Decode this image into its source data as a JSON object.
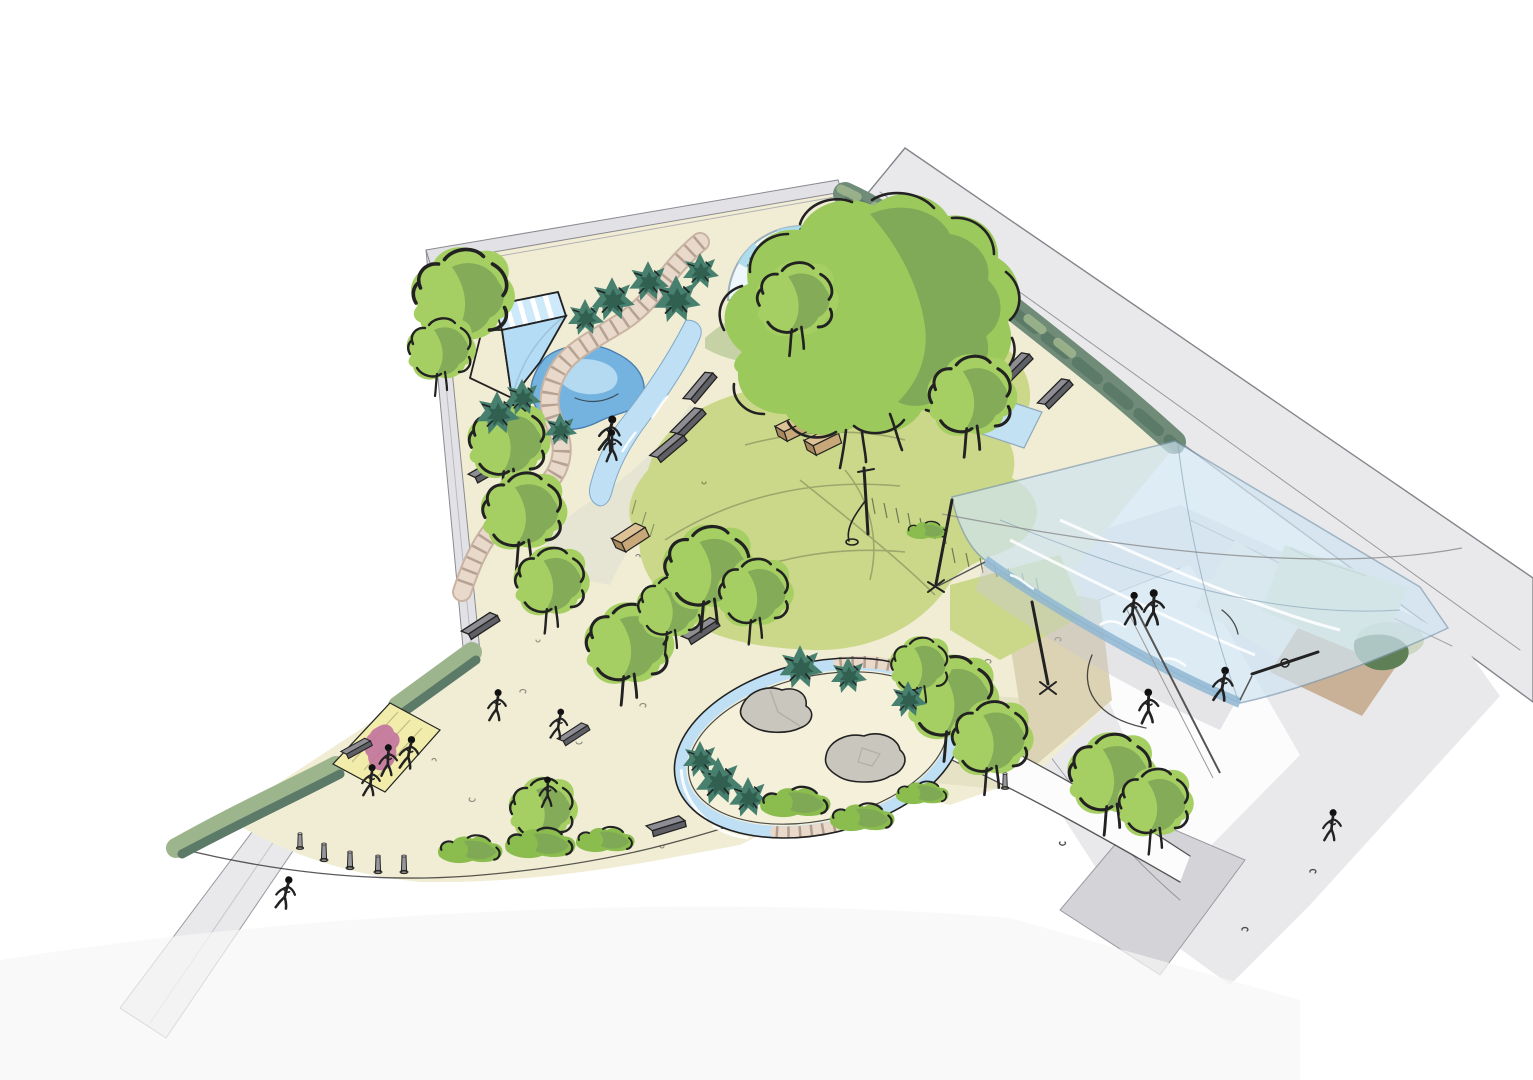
{
  "title": "Hand-drawn aerial concept sketch of a neighbourhood playground park",
  "palette": {
    "ink": "#222222",
    "road": "#e9e9eb",
    "roadShade": "#d4d4d8",
    "roadLine": "#84848a",
    "wall": "#e2e2e6",
    "ground": "#f1edd4",
    "groundShade": "#e3dec2",
    "lawn": "#ccd889",
    "lawnShade": "#b6c478",
    "sage": "#bcc998",
    "hedgeLight": "#9db58d",
    "hedgeMid": "#708c78",
    "hedgeDark": "#5c7a68",
    "treeLight": "#a5cf62",
    "treeMid": "#8abd4e",
    "treeShade": "#7da457",
    "conifer": "#47806f",
    "coniferDark": "#2f5c4e",
    "waterLight": "#bfe0f4",
    "water": "#74b3e0",
    "canopy": "#cfe4f1",
    "canopyEdge": "#8fb7d2",
    "slide": "#cde9fa",
    "slideShade": "#b5dcf5",
    "boardwalk": "#e9d9cb",
    "boardwalkTick": "#a08a7a",
    "bench": "#8d8d93",
    "benchDark": "#5f5f66",
    "planter": "#c8a878",
    "planterDark": "#a8895c",
    "rock": "#c9c6bd",
    "kiosk": "#f2ecab",
    "kioskAccent": "#c2739f",
    "bollard": "#97979d",
    "figure": "#111111"
  },
  "features": [
    "perimeter-road",
    "building-strip",
    "boundary-walls",
    "boundary-hedge",
    "entrance-kiosk",
    "entrance-bollards",
    "water-play-pond",
    "water-slide-structure",
    "winding-boardwalk",
    "stream-channel",
    "splash-pools",
    "sand-play-oval",
    "boulders",
    "striped-dome-pavilion",
    "palm-planting",
    "central-lawn",
    "large-tree",
    "tree-planting",
    "conifer-shrubs",
    "shade-canopy",
    "canopy-masts",
    "benches",
    "planter-boxes",
    "climbing-mast",
    "visitors"
  ]
}
